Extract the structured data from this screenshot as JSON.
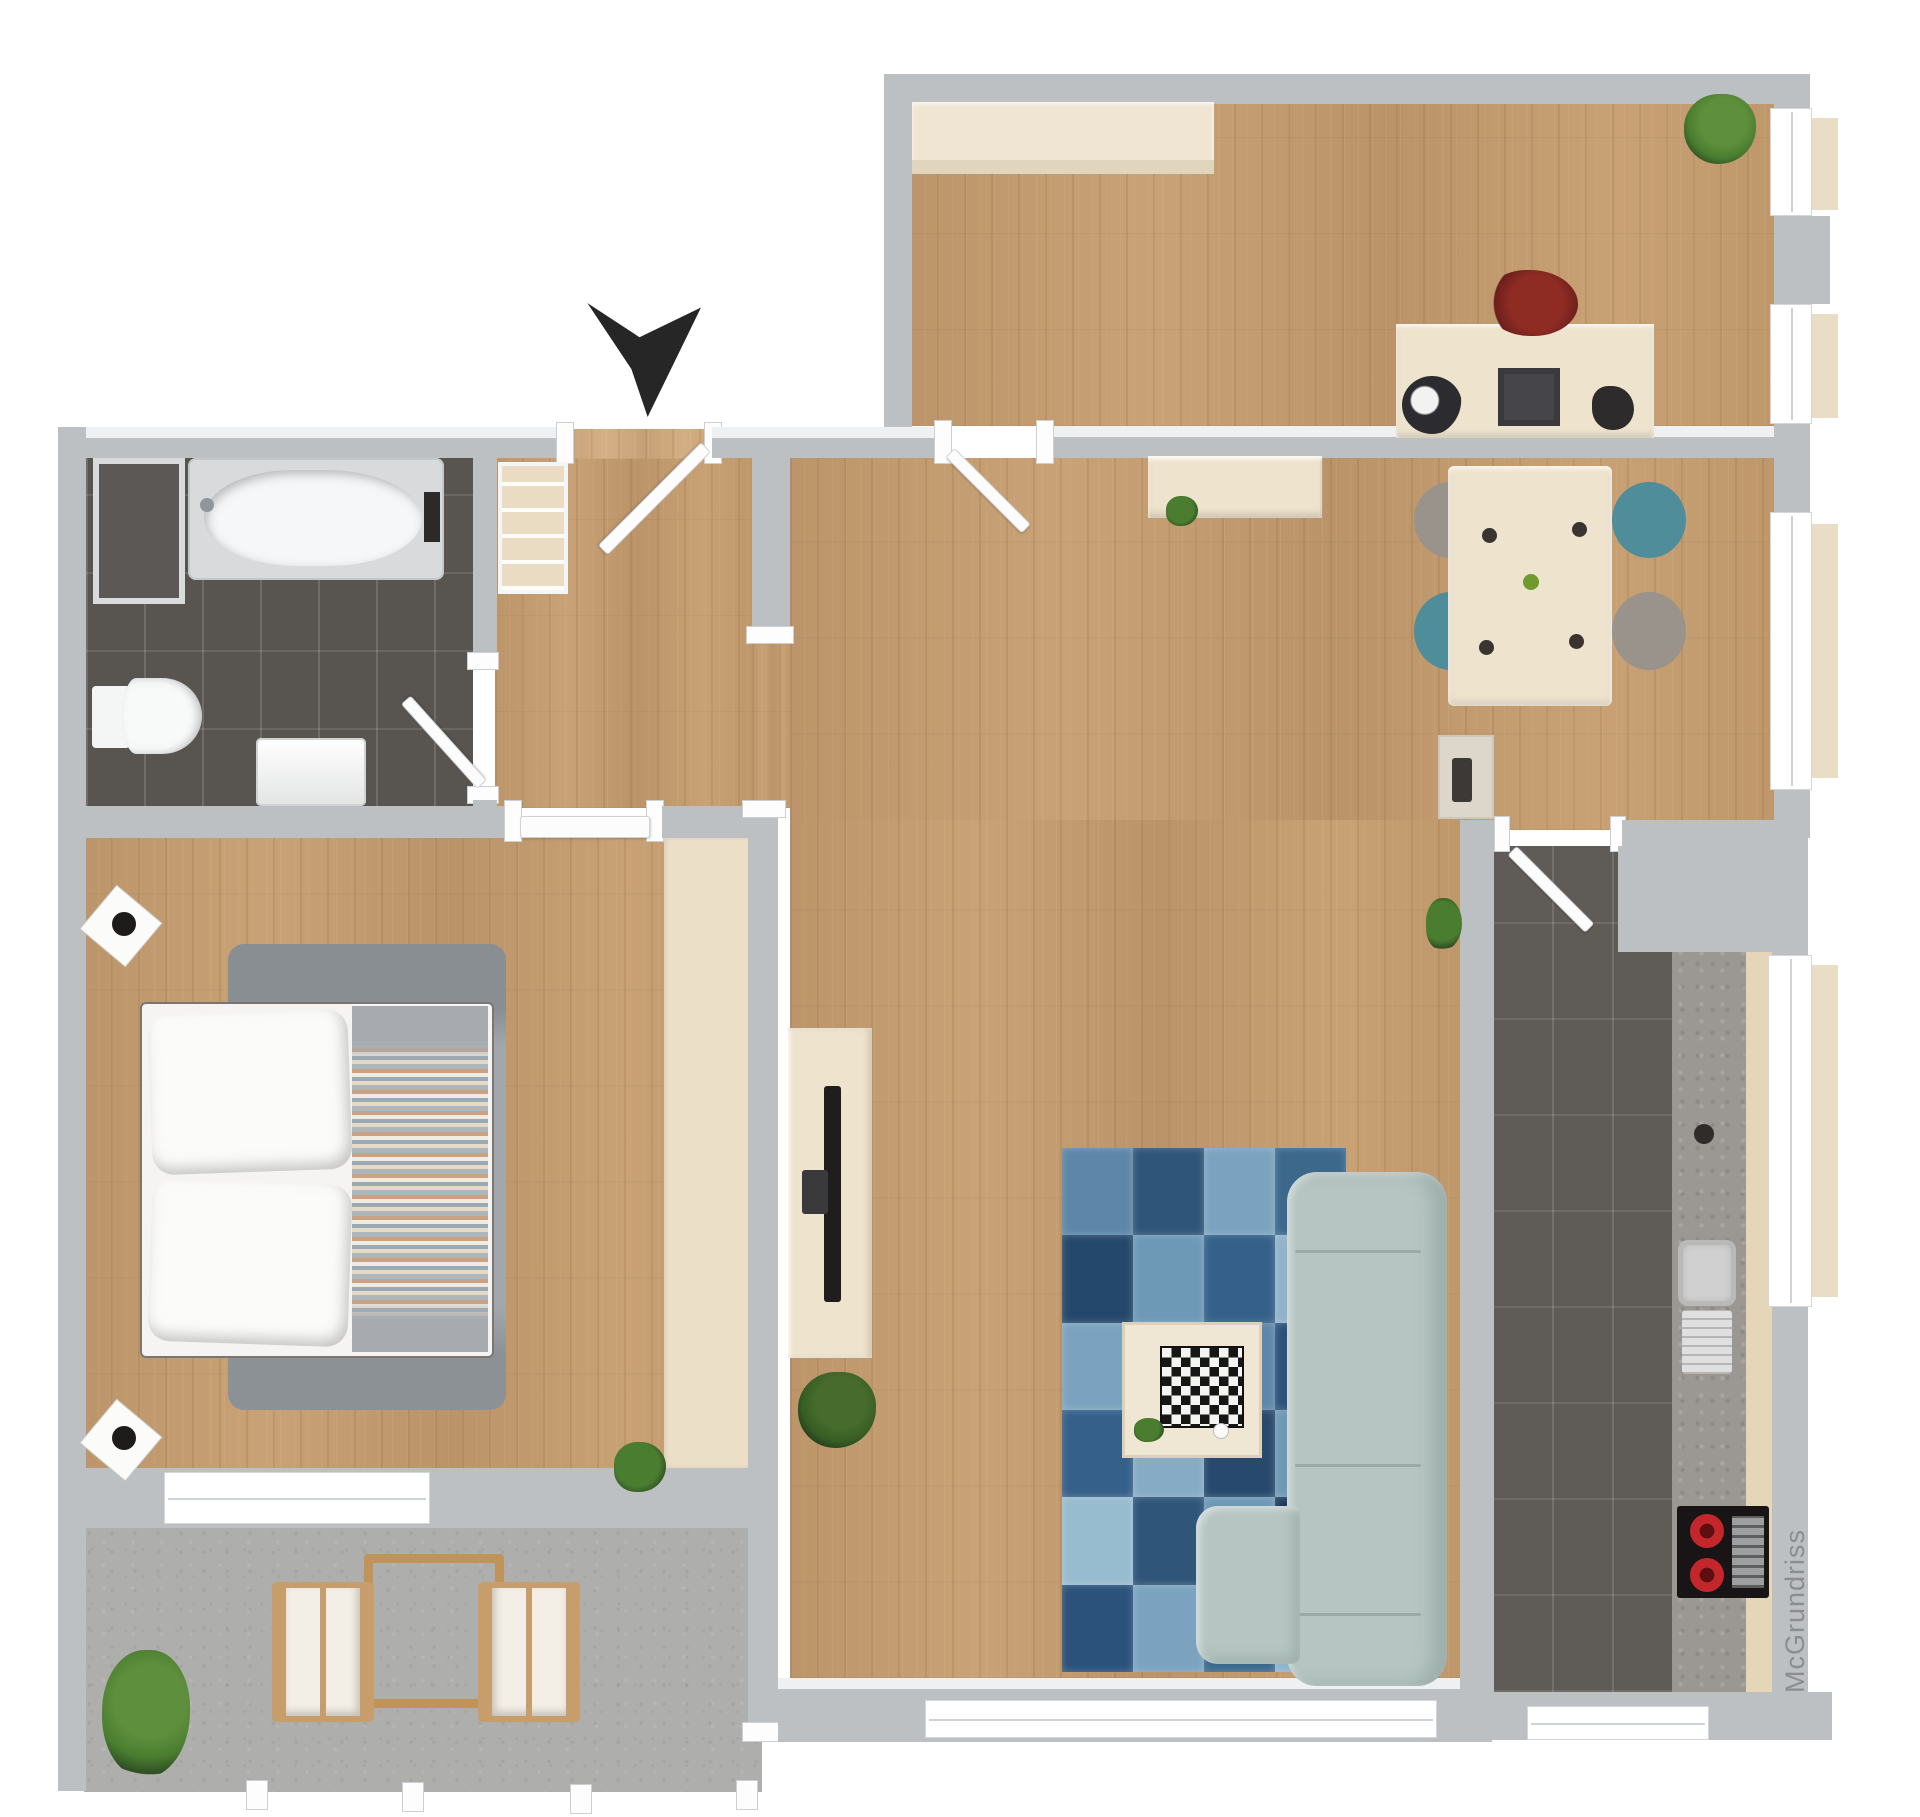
{
  "watermark": {
    "text": "McGrundriss",
    "color": "#8d8d8f"
  },
  "palette": {
    "bg": "#ffffff",
    "wall": "#bcc0c3",
    "window": "#ffffff",
    "sill": "#e9ddc6",
    "wood": "#c69d6f",
    "cream": "#eee3cd",
    "tile_bath": "#585450",
    "tile_kitchen": "#5f5b57",
    "concrete": "#aeaeac",
    "rug_gray": "#a2a7ab",
    "sofa": "#b6c5c2",
    "chair_teal": "#4e8d99",
    "chair_gray": "#99938b",
    "counter_top": "#9b9894",
    "stove_black": "#191415",
    "burner_red": "#c3272b",
    "plant": "#4a7d2f",
    "plant_dark": "#2f4d24",
    "arrow": "#262626",
    "tv_black": "#1f1d1e"
  },
  "living_room": {
    "rug_patches": [
      "#5d86a8",
      "#2f5578",
      "#7ba3bf",
      "#3c688c",
      "#24486b",
      "#6d98b6",
      "#35608a",
      "#8fb3c9",
      "#7ba3bf",
      "#1f3f60",
      "#5d86a8",
      "#2b527a",
      "#35608a",
      "#86abc4",
      "#27496d",
      "#6d98b6",
      "#97bccf",
      "#2f5578",
      "#6d98b6",
      "#1d3c5d",
      "#2b527a",
      "#7ba3bf",
      "#3c688c",
      "#8fb3c9"
    ]
  }
}
